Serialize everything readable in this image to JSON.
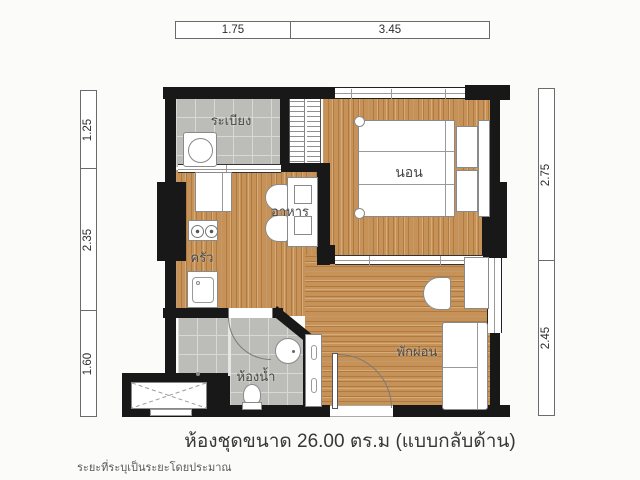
{
  "caption": {
    "text": "ห้องชุดขนาด 26.00 ตร.ม  (แบบกลับด้าน)",
    "disclaimer": "ระยะที่ระบุเป็นระยะโดยประมาณ"
  },
  "rooms": {
    "balcony": "ระเบียง",
    "bedroom": "นอน",
    "dining": "อาหาร",
    "kitchen": "ครัว",
    "bathroom": "ห้องน้ำ",
    "living": "พักผ่อน"
  },
  "dims": {
    "top": [
      "1.75",
      "3.45"
    ],
    "left": [
      "1.25",
      "2.35",
      "1.60"
    ],
    "right": [
      "2.75",
      "2.45"
    ]
  },
  "colors": {
    "wall": "#181818",
    "wood_floor": "#c79257",
    "tile_floor": "#bcbcb8",
    "background": "#fbfbf9"
  }
}
